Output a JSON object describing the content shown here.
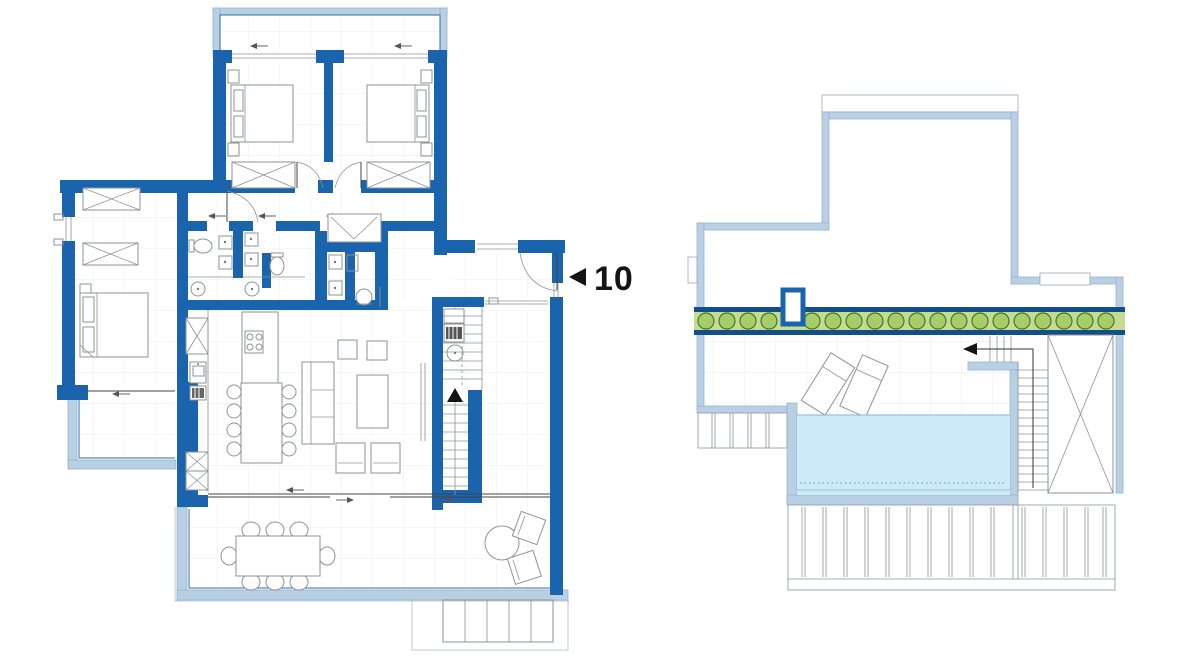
{
  "marker": {
    "number": "10"
  },
  "colors": {
    "paper": "#ffffff",
    "wall": "#1a63ad",
    "light_wall": "#b9cfe4",
    "light_wall_edge": "#93aecb",
    "navy": "#134f86",
    "pool_water": "#cdeaf8",
    "planter_bg": "#c4db92",
    "plant_fill": "#a6cd67",
    "plant_stroke": "#47762b",
    "furniture": "#8f9295",
    "ink": "#141414"
  }
}
